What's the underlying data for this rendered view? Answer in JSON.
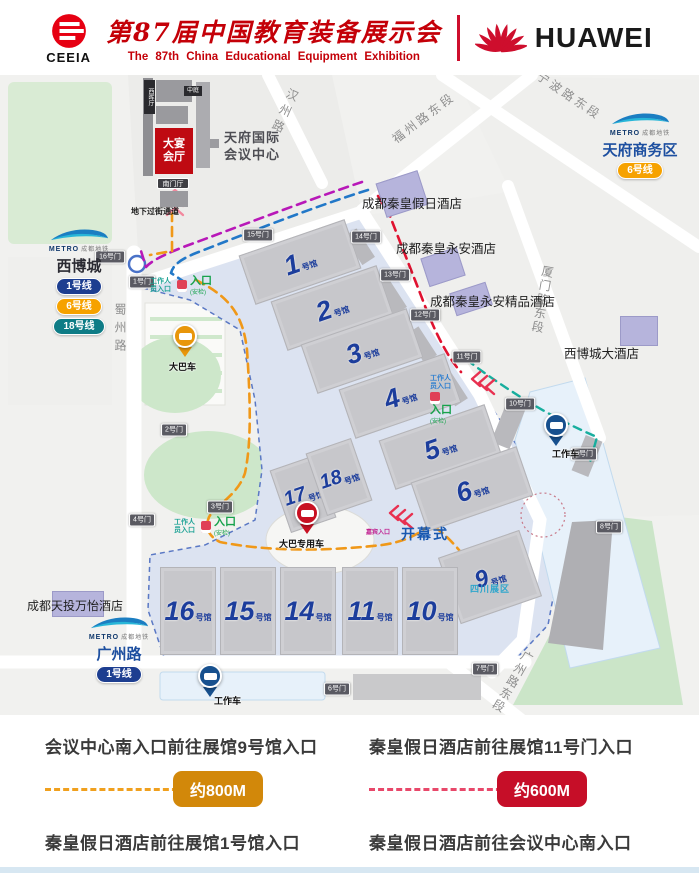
{
  "header": {
    "ceeia": "CEEIA",
    "brand_red": "#E60012",
    "title_cn": "第87届中国教育装备展示会",
    "title_en": "The 87th China  Educational  Equipment  Exhibition",
    "title_red": "#C40008",
    "huawei": "HUAWEI",
    "huawei_red": "#CE0E2D"
  },
  "map": {
    "convention": {
      "west_hall": "西晖厅",
      "atrium": "中庭",
      "banquet": "大宴会厅",
      "south_hall": "南门厅",
      "name": "天府国际会议中心",
      "underpass": "地下过街通道"
    },
    "metro": {
      "brand": "METRO",
      "brand_cn": "成都地铁",
      "xibocheng": {
        "name": "西博城",
        "name_color": "#2B2B33",
        "lines": [
          {
            "label": "1号线",
            "color": "#1D3E90"
          },
          {
            "label": "6号线",
            "color": "#F6A200"
          },
          {
            "label": "18号线",
            "color": "#0E7C86"
          }
        ]
      },
      "tianfu": {
        "name": "天府商务区",
        "name_color": "#1D4FA0",
        "lines": [
          {
            "label": "6号线",
            "color": "#F6A200"
          }
        ]
      },
      "guangzhou": {
        "name": "广州路",
        "name_color": "#1D4FA0",
        "lines": [
          {
            "label": "1号线",
            "color": "#1D3E90"
          }
        ]
      }
    },
    "roads": [
      {
        "name": "汉州路",
        "style": "left:276px;top:12px;writing-mode:vertical-rl;transform:rotate(24deg);letter-spacing:5px"
      },
      {
        "name": "福州路东段",
        "style": "left:386px;top:34px;transform:rotate(-37deg)"
      },
      {
        "name": "宁波路东段",
        "style": "left:532px;top:12px;transform:rotate(34deg)"
      },
      {
        "name": "厦门路东段",
        "style": "left:534px;top:190px;writing-mode:vertical-rl;transform:rotate(10deg);letter-spacing:2px"
      },
      {
        "name": "广州路东段",
        "style": "left:504px;top:572px;writing-mode:vertical-rl;transform:rotate(30deg);letter-spacing:2px"
      },
      {
        "name": "蜀州路",
        "style": "left:112px;top:228px;writing-mode:vertical-rl;letter-spacing:6px"
      }
    ],
    "hotels": [
      {
        "name": "成都秦皇假日酒店",
        "bstyle": "left:380px;top:101px;width:44px;height:36px;transform:rotate(-18deg)",
        "lstyle": "left:362px;top:118px"
      },
      {
        "name": "成都秦皇永安酒店",
        "bstyle": "left:424px;top:177px;width:38px;height:30px;transform:rotate(-18deg)",
        "lstyle": "left:396px;top:163px"
      },
      {
        "name": "成都秦皇永安精品酒店",
        "bstyle": "left:452px;top:212px;width:38px;height:24px;transform:rotate(-18deg)",
        "lstyle": "left:430px;top:216px"
      },
      {
        "name": "西博城大酒店",
        "bstyle": "left:620px;top:241px;width:38px;height:30px",
        "lstyle": "left:564px;top:268px"
      },
      {
        "name": "成都天投万怡酒店",
        "bstyle": "left:52px;top:516px;width:52px;height:26px",
        "lstyle": "left:27px;top:522px;font-size:12px"
      }
    ],
    "halls": [
      {
        "num": "1",
        "suffix": "号馆",
        "style": "left:244px;top:161px;width:112px;height:52px;transform:rotate(-19deg)"
      },
      {
        "num": "2",
        "suffix": "号馆",
        "style": "left:276px;top:207px;width:112px;height:52px;transform:rotate(-19deg)"
      },
      {
        "num": "3",
        "suffix": "号馆",
        "style": "left:306px;top:250px;width:112px;height:52px;transform:rotate(-19deg)"
      },
      {
        "num": "4",
        "suffix": "号馆",
        "style": "left:344px;top:295px;width:112px;height:52px;trans­form:rotate(-19deg);transform:rotate(-19deg)"
      },
      {
        "num": "5",
        "suffix": "号馆",
        "style": "left:384px;top:346px;width:112px;height:52px;transform:rotate(-19deg)"
      },
      {
        "num": "6",
        "suffix": "号馆",
        "style": "left:416px;top:388px;width:112px;height:52px;transform:rotate(-19deg)"
      },
      {
        "num": "17",
        "suffix": "号馆",
        "style": "left:279px;top:386px;width:48px;height:66px;transform:rotate(-19deg)",
        "fs": "20px"
      },
      {
        "num": "18",
        "suffix": "号馆",
        "style": "left:315px;top:369px;width:48px;height:66px;transform:rotate(-19deg)",
        "fs": "20px"
      },
      {
        "num": "9",
        "suffix": "号馆",
        "style": "left:447px;top:467px;width:86px;height:70px;transform:rotate(-19deg)",
        "fs": "24px"
      },
      {
        "num": "16",
        "suffix": "号馆",
        "style": "left:160px;top:492px;width:56px;height:88px"
      },
      {
        "num": "15",
        "suffix": "号馆",
        "style": "left:220px;top:492px;width:56px;height:88px"
      },
      {
        "num": "14",
        "suffix": "号馆",
        "style": "left:280px;top:492px;width:56px;height:88px"
      },
      {
        "num": "11",
        "suffix": "号馆",
        "style": "left:342px;top:492px;width:56px;height:88px"
      },
      {
        "num": "10",
        "suffix": "号馆",
        "style": "left:402px;top:492px;width:56px;height:88px"
      }
    ],
    "sichuan_note": "四川展区",
    "sichuan_color": "#2EA6CC",
    "gates": [
      {
        "label": "1号门",
        "style": "left:142px;top:207px"
      },
      {
        "label": "2号门",
        "style": "left:174px;top:355px"
      },
      {
        "label": "3号门",
        "style": "left:220px;top:432px"
      },
      {
        "label": "4号门",
        "style": "left:142px;top:445px"
      },
      {
        "label": "6号门",
        "style": "left:337px;top:614px"
      },
      {
        "label": "7号门",
        "style": "left:485px;top:594px"
      },
      {
        "label": "8号门",
        "style": "left:609px;top:452px"
      },
      {
        "label": "9号门",
        "style": "left:584px;top:379px"
      },
      {
        "label": "10号门",
        "style": "left:520px;top:329px"
      },
      {
        "label": "11号门",
        "style": "left:467px;top:282px"
      },
      {
        "label": "12号门",
        "style": "left:425px;top:240px"
      },
      {
        "label": "13号门",
        "style": "left:395px;top:200px"
      },
      {
        "label": "14号门",
        "style": "left:366px;top:162px"
      },
      {
        "label": "15号门",
        "style": "left:258px;top:160px"
      },
      {
        "label": "16号门",
        "style": "left:110px;top:182px"
      }
    ],
    "pins": [
      {
        "label": "大巴车",
        "color": "#E8960A",
        "style": "left:173px;top:249px",
        "lstyle": "left:-4px;top:36px"
      },
      {
        "label": "大巴专用车",
        "color": "#C81022",
        "style": "left:295px;top:426px",
        "lstyle": "left:-16px;top:36px"
      },
      {
        "label": "工作车",
        "color": "#17508E",
        "style": "left:544px;top:338px",
        "lstyle": "left:8px;top:34px"
      },
      {
        "label": "工作车",
        "color": "#17508E",
        "style": "left:198px;top:589px",
        "lstyle": "left:16px;top:30px"
      }
    ],
    "entrances": [
      {
        "staff": "工作人员入口",
        "staff_color": "#1FA396",
        "gate": "入口",
        "gate_color": "#17A24C",
        "note": "(安检)",
        "style": "left:150px;top:201px"
      },
      {
        "staff": "工作人员入口",
        "staff_color": "#2F7FD0",
        "gate": "入口",
        "gate_color": "#17A24C",
        "note": "(安检)",
        "style": "left:430px;top:300px;flex-direction:column;align-items:flex-start;gap:1px"
      },
      {
        "staff": "工作人员入口",
        "staff_color": "#1FA396",
        "gate": "入口",
        "gate_color": "#17A24C",
        "note": "(安检)",
        "style": "left:174px;top:442px"
      }
    ],
    "labels": {
      "opening": "开幕式",
      "opening_color": "#1858B0",
      "guest": "嘉宾入口",
      "guest_color": "#C02090"
    },
    "routes": [
      {
        "name": "route-hotel-to-cc-magenta",
        "color": "#B818B8",
        "d": "M362,107 C305,126 235,153 186,171 C168,178 152,185 146,192 L141,176",
        "dash": "9 6",
        "w": 2.6
      },
      {
        "name": "route-hotel-to-hall1-blue",
        "color": "#2278C8",
        "d": "M368,115 C310,133 240,161 196,178 C181,184 173,190 171,198 L186,208",
        "dash": "9 6",
        "w": 2.6
      },
      {
        "name": "route-hotel-to-gate11-red",
        "color": "#E01230",
        "d": "M378,121 L390,141 C398,162 412,197 425,231 C436,259 448,283 461,297",
        "dash": "9 6",
        "w": 2.6
      },
      {
        "name": "route-cc-to-hall9-orange",
        "color": "#F09818",
        "d": "M172,137 L172,176 L150,180 M196,205 C230,222 243,240 247,275 C250,320 252,365 245,398 C238,420 216,430 209,442 C205,452 208,461 220,467 C270,477 330,476 382,470 C404,467 420,459 430,449 C442,456 456,470 466,484",
        "dash": "9 6",
        "w": 2.6
      },
      {
        "name": "route-staff-teal",
        "color": "#18AE9E",
        "d": "M467,285 C500,310 545,340 597,362 L590,387",
        "dash": "8 6",
        "w": 2.4
      },
      {
        "name": "underpass-chevrons",
        "color": "#F2899E",
        "d": "M167,122 L175,115 L183,122 M167,131 L175,124 L183,131 M167,140 L175,133 L183,140",
        "w": 2.4
      },
      {
        "name": "east-entrance-chevrons",
        "color": "#E83050",
        "d": "M480,297 L472,304 L480,311 M487,301 L479,308 L487,315 M494,305 L486,312 L494,319",
        "w": 2.4
      },
      {
        "name": "south-entrance-chevrons",
        "color": "#E83050",
        "d": "M398,431 L390,438 L398,445 M405,435 L397,442 L405,449 M412,439 L404,446 L412,453",
        "w": 2.4
      }
    ]
  },
  "legend": {
    "items": [
      {
        "title": "会议中心南入口前往展馆9号馆入口",
        "distance": "约800M",
        "dash": "#F0A01E",
        "badge": "#D2880A"
      },
      {
        "title": "秦皇假日酒店前往展馆11号门入口",
        "distance": "约600M",
        "dash": "#E8486A",
        "badge": "#C60E28"
      },
      {
        "title": "秦皇假日酒店前往展馆1号馆入口",
        "distance": "约620M",
        "dash": "#2E86C8",
        "badge": "#1878BE"
      },
      {
        "title": "秦皇假日酒店前往会议中心南入口",
        "distance": "约580M",
        "dash": "#C838B4",
        "badge": "#A50AA5"
      }
    ]
  }
}
